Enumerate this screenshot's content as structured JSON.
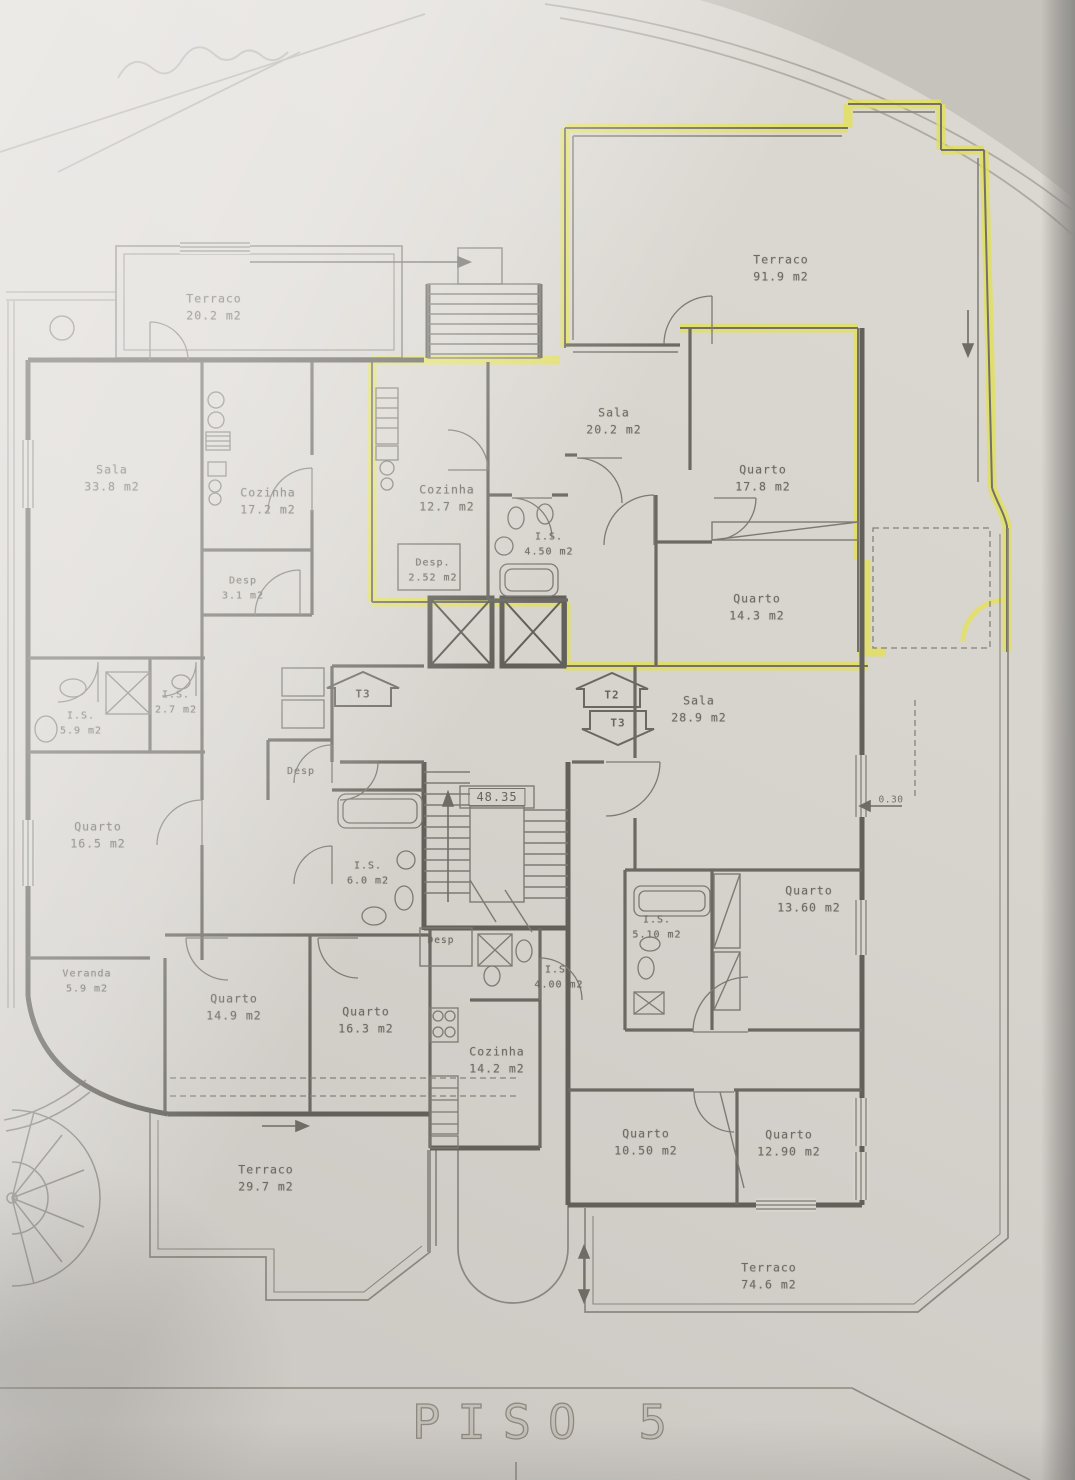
{
  "document": {
    "title": "PISO 5",
    "level_marker": "48.35",
    "dimension_label": "0.30"
  },
  "unit_markers": [
    {
      "label": "T3",
      "direction": "up"
    },
    {
      "label": "T2",
      "direction": "up"
    },
    {
      "label": "T3",
      "direction": "down"
    }
  ],
  "rooms": [
    {
      "name": "Terraco",
      "area": "20.2 m2"
    },
    {
      "name": "Terraco",
      "area": "91.9 m2"
    },
    {
      "name": "Sala",
      "area": "33.8 m2"
    },
    {
      "name": "Cozinha",
      "area": "17.2 m2"
    },
    {
      "name": "Cozinha",
      "area": "12.7 m2"
    },
    {
      "name": "Sala",
      "area": "20.2 m2"
    },
    {
      "name": "Quarto",
      "area": "17.8 m2"
    },
    {
      "name": "Desp.",
      "area": "2.52 m2"
    },
    {
      "name": "I.S.",
      "area": "4.50 m2"
    },
    {
      "name": "Desp",
      "area": "3.1 m2"
    },
    {
      "name": "Quarto",
      "area": "14.3 m2"
    },
    {
      "name": "I.S.",
      "area": "5.9 m2"
    },
    {
      "name": "I.S.",
      "area": "2.7 m2"
    },
    {
      "name": "Sala",
      "area": "28.9 m2"
    },
    {
      "name": "Quarto",
      "area": "16.5 m2"
    },
    {
      "name": "Desp"
    },
    {
      "name": "I.S.",
      "area": "6.0 m2"
    },
    {
      "name": "Quarto",
      "area": "13.60 m2"
    },
    {
      "name": "I.S.",
      "area": "5.10 m2"
    },
    {
      "name": "Veranda",
      "area": "5.9 m2"
    },
    {
      "name": "Quarto",
      "area": "14.9 m2"
    },
    {
      "name": "Quarto",
      "area": "16.3 m2"
    },
    {
      "name": "Desp"
    },
    {
      "name": "I.S.",
      "area": "4.00 m2"
    },
    {
      "name": "Cozinha",
      "area": "14.2 m2"
    },
    {
      "name": "Quarto",
      "area": "10.50 m2"
    },
    {
      "name": "Quarto",
      "area": "12.90 m2"
    },
    {
      "name": "Terraco",
      "area": "29.7 m2"
    },
    {
      "name": "Terraco",
      "area": "74.6 m2"
    }
  ],
  "colors": {
    "paper": "#d8d4ce",
    "wall": "#62605a",
    "highlight": "#e3e05c",
    "ink": "#6e6b63"
  }
}
